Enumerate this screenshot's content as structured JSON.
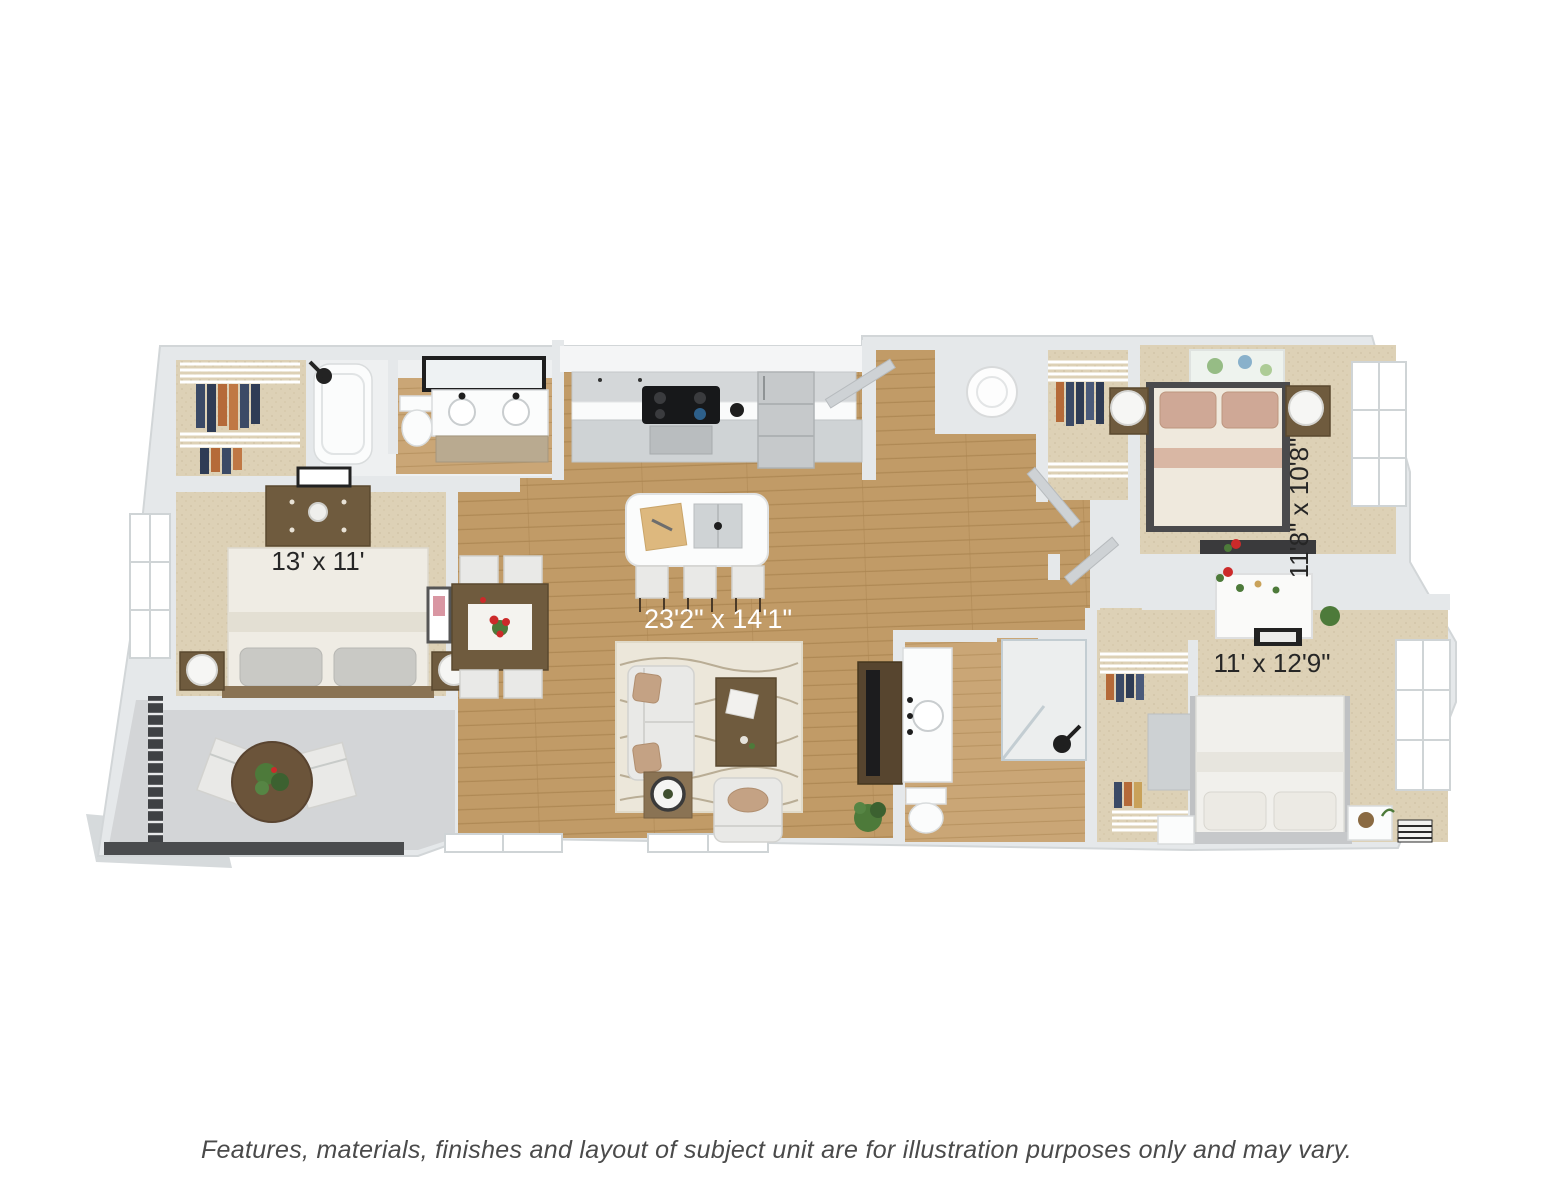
{
  "floor_plan": {
    "rooms": [
      {
        "id": "bedroom-left",
        "dimensions": "13' x 11'"
      },
      {
        "id": "living-dining-kitchen",
        "dimensions": "23'2\" x 14'1\""
      },
      {
        "id": "bedroom-top-right",
        "dimensions": "11'8\" x 10'8\""
      },
      {
        "id": "bedroom-bottom-right",
        "dimensions": "11' x 12'9\""
      }
    ]
  },
  "footer": {
    "disclaimer": "Features, materials, finishes and layout of subject unit are for illustration purposes only and may vary."
  },
  "palette": {
    "background": "#ffffff",
    "wall": "#e5e8ea",
    "wood_floor": "#c19b67",
    "carpet": "#ddd1b6",
    "balcony_floor": "#d3d5d7",
    "furniture_wood": "#6f5b3e",
    "tv_console": "#57452f",
    "upholstery": "#e9e9e7",
    "pillow_tan": "#c4a284",
    "railing": "#3f4144",
    "plant_green": "#4d7a3a",
    "flower_red": "#cc2a2a",
    "label_dark": "#262626",
    "label_light": "#ffffff",
    "caption_gray": "#4a4a4a"
  }
}
